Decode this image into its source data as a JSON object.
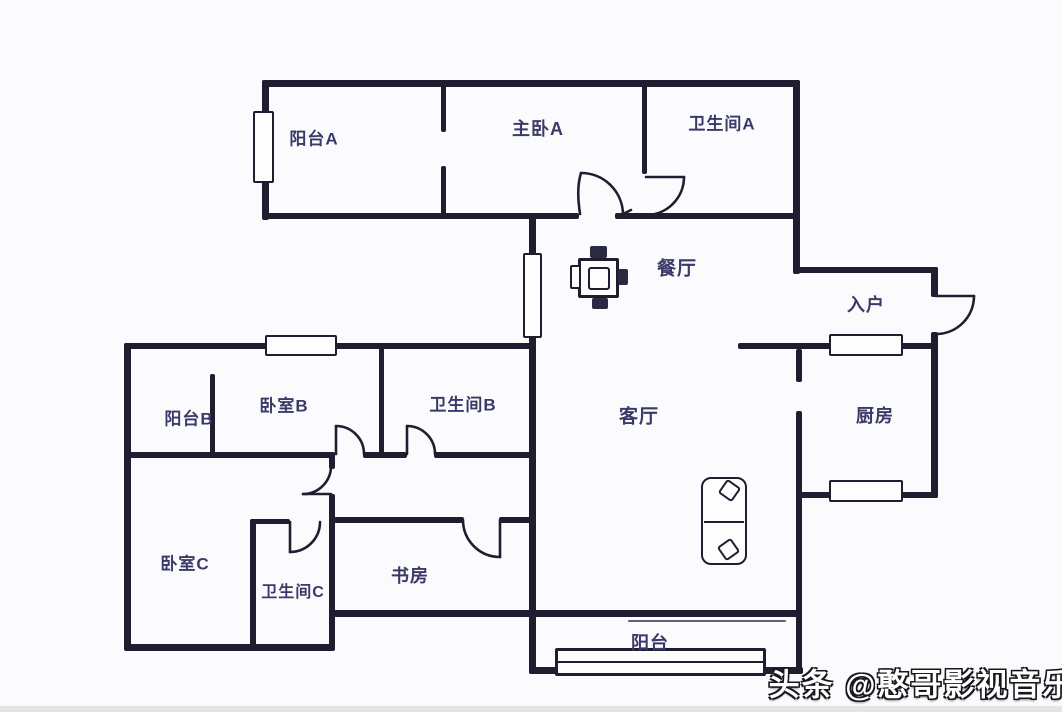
{
  "rooms": {
    "balcony_a": {
      "label": "阳台A"
    },
    "master_bedroom": {
      "label": "主卧A"
    },
    "bathroom_a": {
      "label": "卫生间A"
    },
    "dining": {
      "label": "餐厅"
    },
    "entry": {
      "label": "入户"
    },
    "balcony_b": {
      "label": "阳台B"
    },
    "bedroom_b": {
      "label": "卧室B"
    },
    "bathroom_b": {
      "label": "卫生间B"
    },
    "living": {
      "label": "客厅"
    },
    "kitchen": {
      "label": "厨房"
    },
    "bedroom_c": {
      "label": "卧室C"
    },
    "bathroom_c": {
      "label": "卫生间C"
    },
    "study": {
      "label": "书房"
    },
    "balcony_south": {
      "label": "阳台"
    }
  },
  "watermark": {
    "text": "头条 @憨哥影视音乐"
  },
  "colors": {
    "wall": "#1e1e30",
    "label": "#3a3a68",
    "background": "#fbfbfd"
  }
}
